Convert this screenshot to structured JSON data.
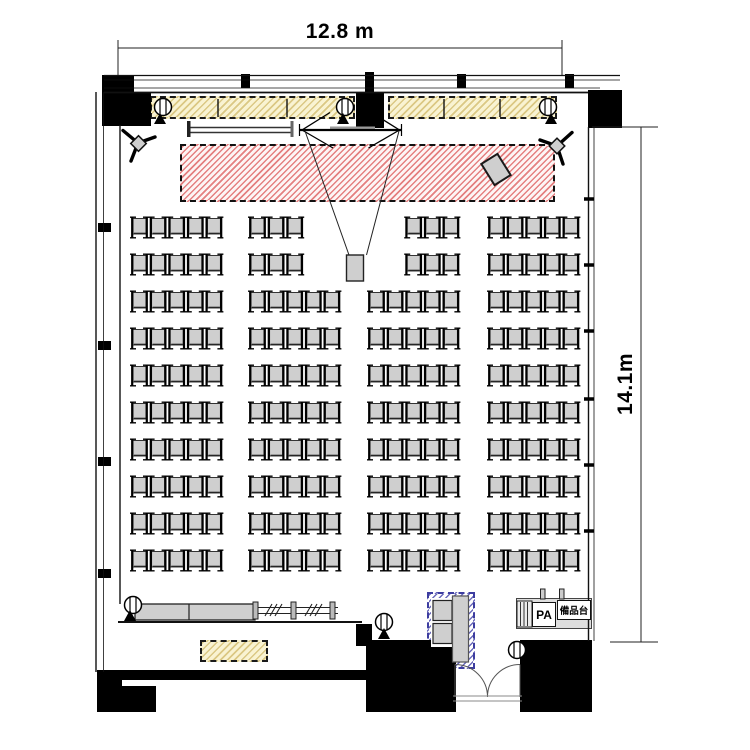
{
  "plan": {
    "name": "Seminar room floor plan (theater seating)",
    "width_label": "12.8 m",
    "depth_label": "14.1m",
    "pa_label": "PA",
    "equipment_stand_label": "備品台",
    "capacity_seats": 192
  },
  "colors": {
    "wall": "#000000",
    "chair_fill": "#cfcfcf",
    "chair_stroke": "#222222",
    "chair_bar": "#000000",
    "stage_hatch": "#dd5a5a",
    "batten_hatch": "#c6ac50",
    "rack_hatch": "#4646aa"
  },
  "seating": {
    "rows_y": [
      216,
      253,
      290,
      327,
      364,
      401,
      438,
      475,
      512,
      549
    ],
    "blocks_x": [
      131,
      249,
      368,
      488
    ],
    "seats_per_block": 5,
    "seat_pitch": 18.6,
    "chair_width": 17,
    "chair_height": 23,
    "reduced_rows": [
      0,
      1
    ],
    "reduced_blocks": [
      {
        "block": 1,
        "count": 3,
        "align": "left"
      },
      {
        "block": 2,
        "count": 3,
        "align": "right"
      }
    ]
  },
  "equipment": [
    {
      "name": "projection-screen"
    },
    {
      "name": "projector"
    },
    {
      "name": "stage-area"
    },
    {
      "name": "light-batten",
      "count": 2
    },
    {
      "name": "stage-light-tripod",
      "count": 2
    },
    {
      "name": "ceiling-light",
      "count": 3
    },
    {
      "name": "floor-light",
      "count": 3
    },
    {
      "name": "whiteboard"
    },
    {
      "name": "lectern"
    },
    {
      "name": "counter-table"
    },
    {
      "name": "stacked-tables"
    },
    {
      "name": "storage-area"
    },
    {
      "name": "av-rack"
    },
    {
      "name": "pa-console"
    },
    {
      "name": "equipment-stand"
    },
    {
      "name": "double-door"
    }
  ]
}
